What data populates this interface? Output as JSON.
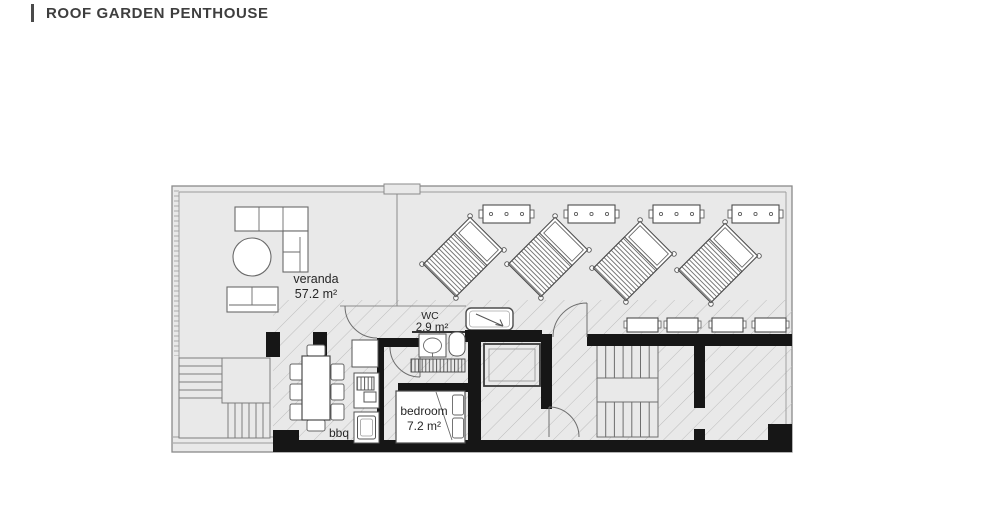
{
  "header": {
    "title": "ROOF GARDEN PENTHOUSE"
  },
  "plan": {
    "rooms": [
      {
        "label": "veranda",
        "area": "57.2 m²"
      },
      {
        "label": "WC",
        "area": "2.9 m²"
      },
      {
        "label": "bedroom",
        "area": "7.2 m²"
      }
    ],
    "labels": {
      "bbq": "bbq"
    },
    "colors": {
      "floor": "#e9e9e9",
      "wall": "#161616",
      "furniture_line": "#5f5f5f",
      "thin_line": "#8a8a8a",
      "hatch_line": "#bdbdbd",
      "text": "#2b2b2b",
      "title": "#3e3e3e",
      "accent_bar": "#4a4a4a"
    }
  }
}
